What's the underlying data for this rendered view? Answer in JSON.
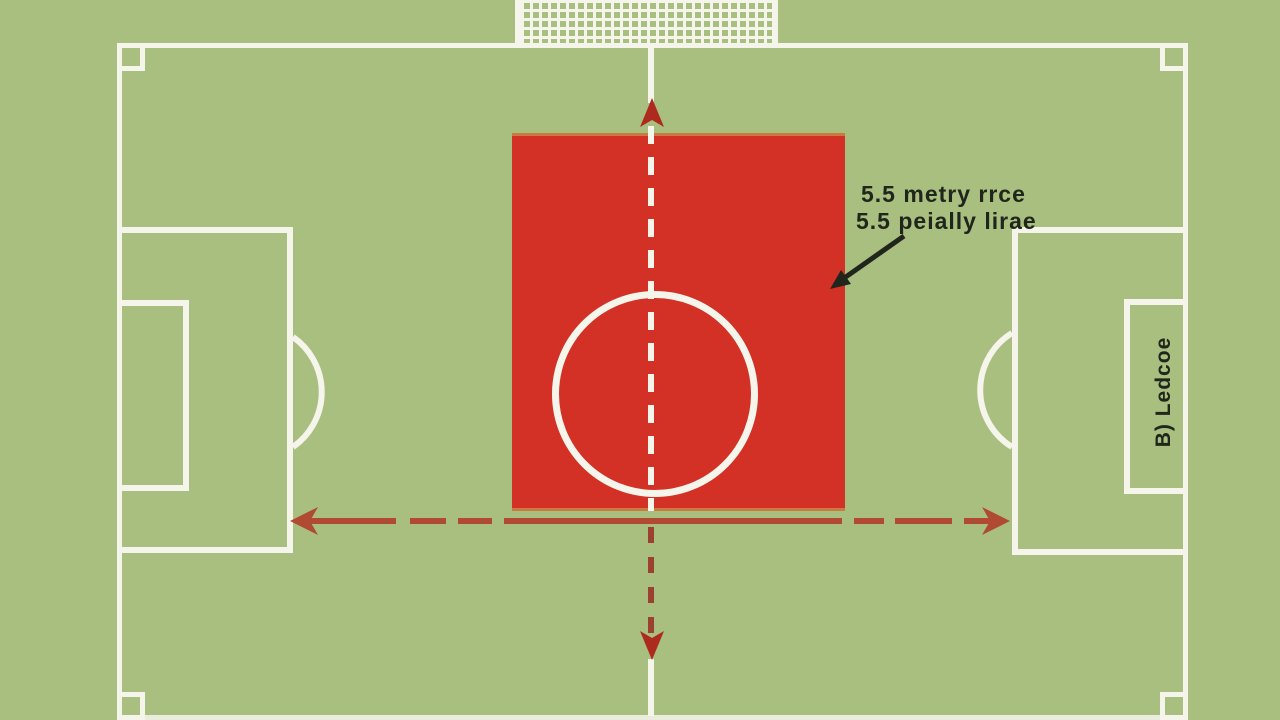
{
  "diagram": {
    "kind": "soccer-pitch-top-view",
    "annotations": {
      "measure_line1": "5.5 metry rrce",
      "measure_line2": "5.5 peially lirae",
      "side_label": "B) Ledcoe"
    }
  },
  "colors": {
    "field-green": "#a9bf80",
    "line-white": "#f6f5ec",
    "zone-red": "#d43126",
    "zone-border-orange": "#c97a41",
    "arrow-brick": "#b04a32",
    "dash-red": "#9c4130",
    "arrowhead-red": "#ac2a1e",
    "ink-black": "#20261b"
  }
}
